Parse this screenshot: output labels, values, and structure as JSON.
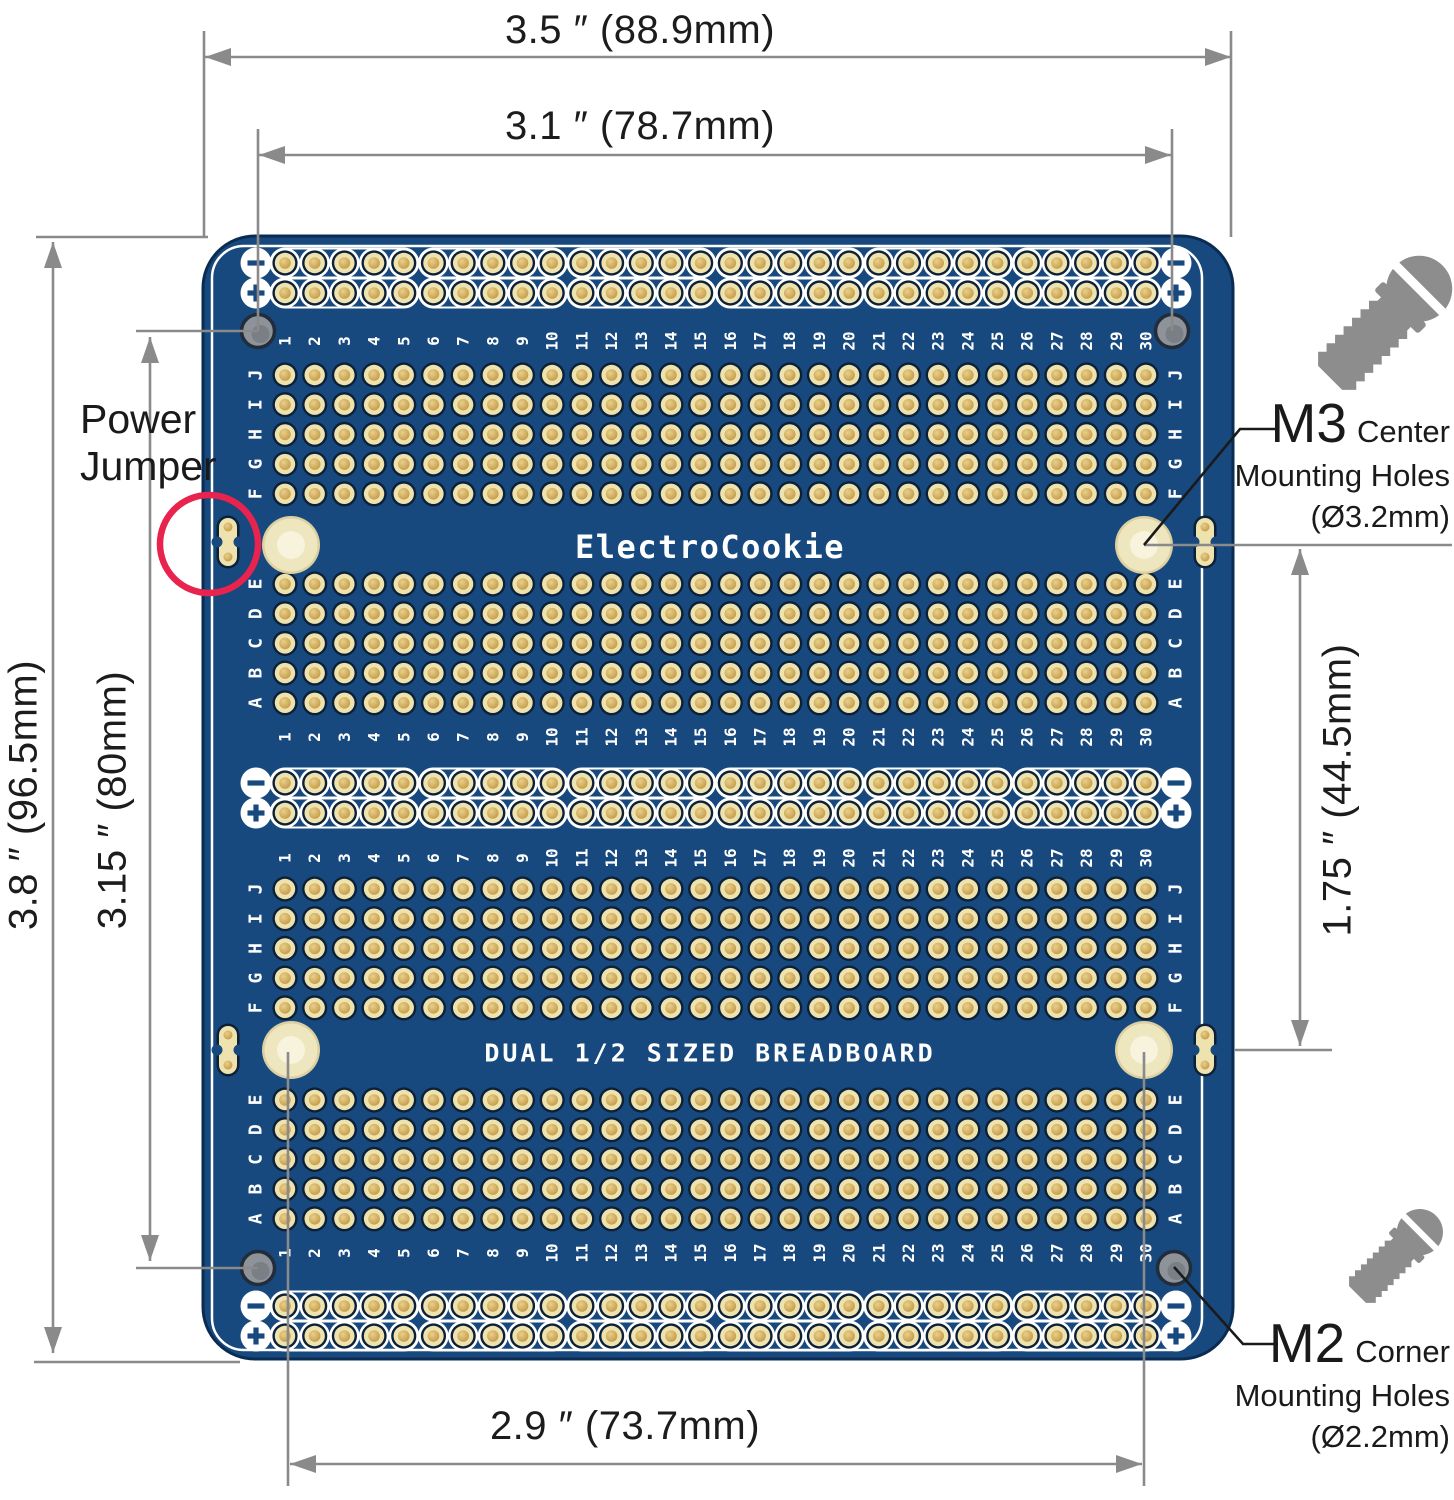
{
  "dimensions": {
    "overall_width": "3.5 ″ (88.9mm)",
    "inner_width": "3.1 ″ (78.7mm)",
    "overall_height": "3.8 ″ (96.5mm)",
    "inner_height": "3.15 ″ (80mm)",
    "center_holes_vertical": "1.75 ″ (44.5mm)",
    "center_holes_horizontal": "2.9 ″ (73.7mm)"
  },
  "callouts": {
    "power_jumper": {
      "line1": "Power",
      "line2": "Jumper"
    },
    "m3": {
      "code": "M3",
      "kind": "Center",
      "line2": "Mounting Holes",
      "line3": "(Ø3.2mm)"
    },
    "m2": {
      "code": "M2",
      "kind": "Corner",
      "line2": "Mounting Holes",
      "line3": "(Ø2.2mm)"
    }
  },
  "board": {
    "brand": "ElectroCookie",
    "label": "DUAL 1/2 SIZED BREADBOARD",
    "columns": 30,
    "upper_row_letters": [
      "J",
      "I",
      "H",
      "G",
      "F"
    ],
    "lower_row_letters": [
      "E",
      "D",
      "C",
      "B",
      "A"
    ],
    "rail_negative_symbol": "−",
    "rail_positive_symbol": "+"
  },
  "colors": {
    "pcb_blue": "#17497E",
    "silkscreen_white": "#FFFFFF",
    "pad_ring_gold": "#EEE2AE",
    "pad_center_gold": "#C9A14F",
    "pad_ring_dark": "#0C2038",
    "mount_hole_gray": "#8E9399",
    "highlight_red": "#E8234E",
    "dimension_gray": "#8A8A8A",
    "screw_gray": "#8D8D8D",
    "label_black": "#1A1A1A"
  }
}
